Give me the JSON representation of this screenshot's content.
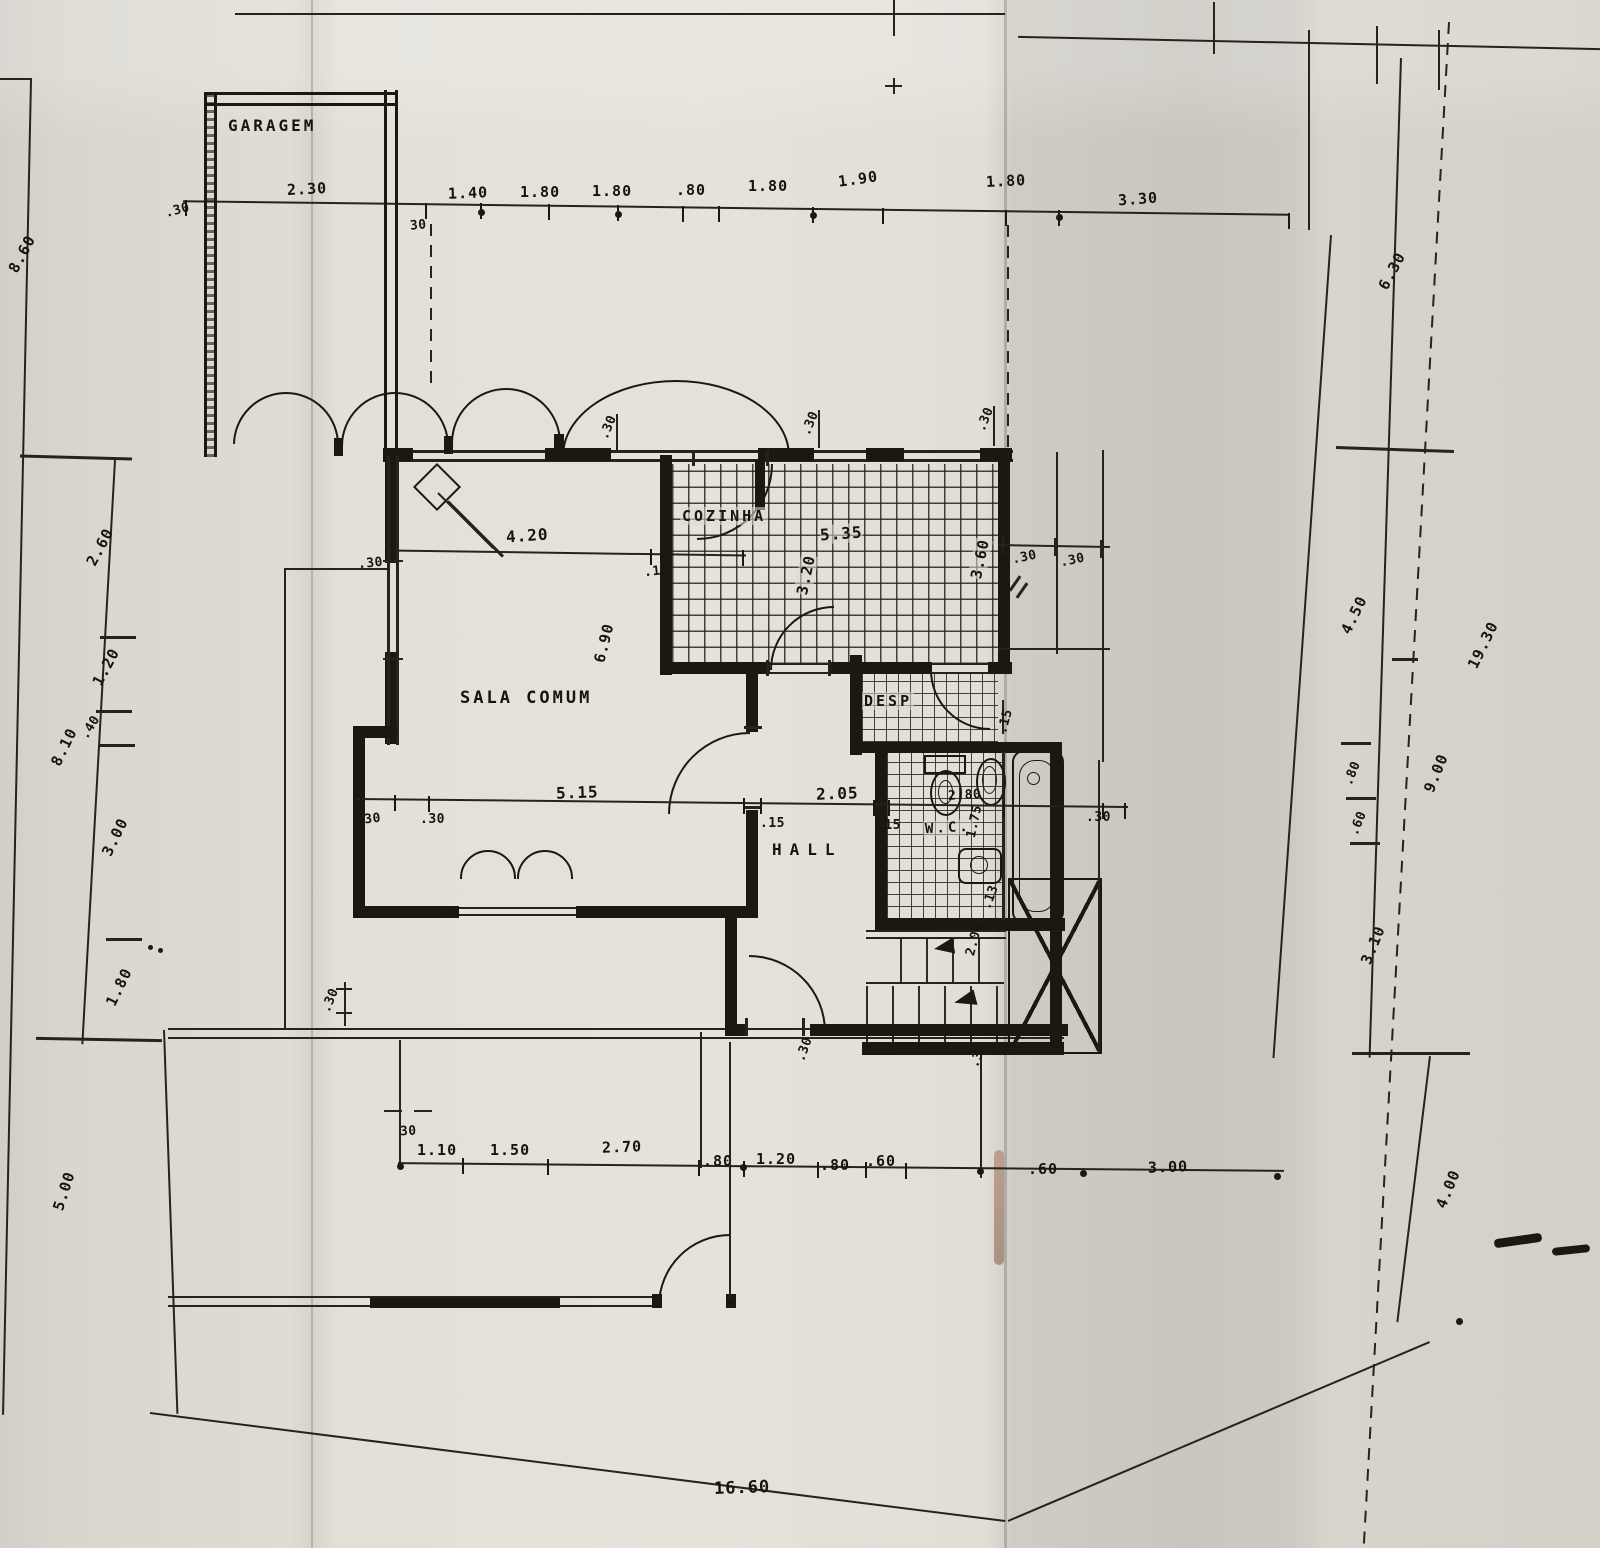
{
  "rooms": {
    "garage": "GARAGEM",
    "living": "SALA COMUM",
    "kitchen": "COZINHA",
    "pantry": "DESP",
    "wc": "W.C.",
    "hall": "HALL"
  },
  "d": {
    "top30a": ".30",
    "top230": "2.30",
    "top30b": "30",
    "t140": "1.40",
    "t180a": "1.80",
    "t180b": "1.80",
    "t080": ".80",
    "t180c": "1.80",
    "t190": "1.90",
    "t180d": "1.80",
    "t330": "3.30",
    "l860": "8.60",
    "l810": "8.10",
    "l500": "5.00",
    "li260": "2.60",
    "li120": "1.20",
    "li040": ".40",
    "li300": "3.00",
    "li180": "1.80",
    "r450": "4.50",
    "r080": ".80",
    "r060": ".60",
    "r310": "3.10",
    "rm630": "6.30",
    "rm900": "9.00",
    "rm400": "4.00",
    "lot1930": "19.30",
    "lot1660": "16.60",
    "b30": "30",
    "b110": "1.10",
    "b150": "1.50",
    "b270": "2.70",
    "b080a": ".80",
    "b120": "1.20",
    "b080b": ".80",
    "b060a": ".60",
    "b060b": ".60",
    "b300": "3.00",
    "s420": "4.20",
    "s30": ".30",
    "s15": ".15",
    "s690": "6.90",
    "k535": "5.35",
    "k320": "3.20",
    "k360": "3.60",
    "wt30a": ".30",
    "wt30b": ".30",
    "wt30c": ".30",
    "ne30a": ".30",
    "ne30b": ".30",
    "m30a": ".30",
    "m30b": ".30",
    "m515": "5.15",
    "m15a": ".15",
    "m205": "2.05",
    "m15b": ".15",
    "m280": "2.80",
    "m30c": ".30",
    "wc175": "1.75",
    "wc15": ".15",
    "wc13": ".13",
    "st200": "2.00",
    "p30a": ".30",
    "p30b": ".30",
    "p30c": ".30"
  }
}
